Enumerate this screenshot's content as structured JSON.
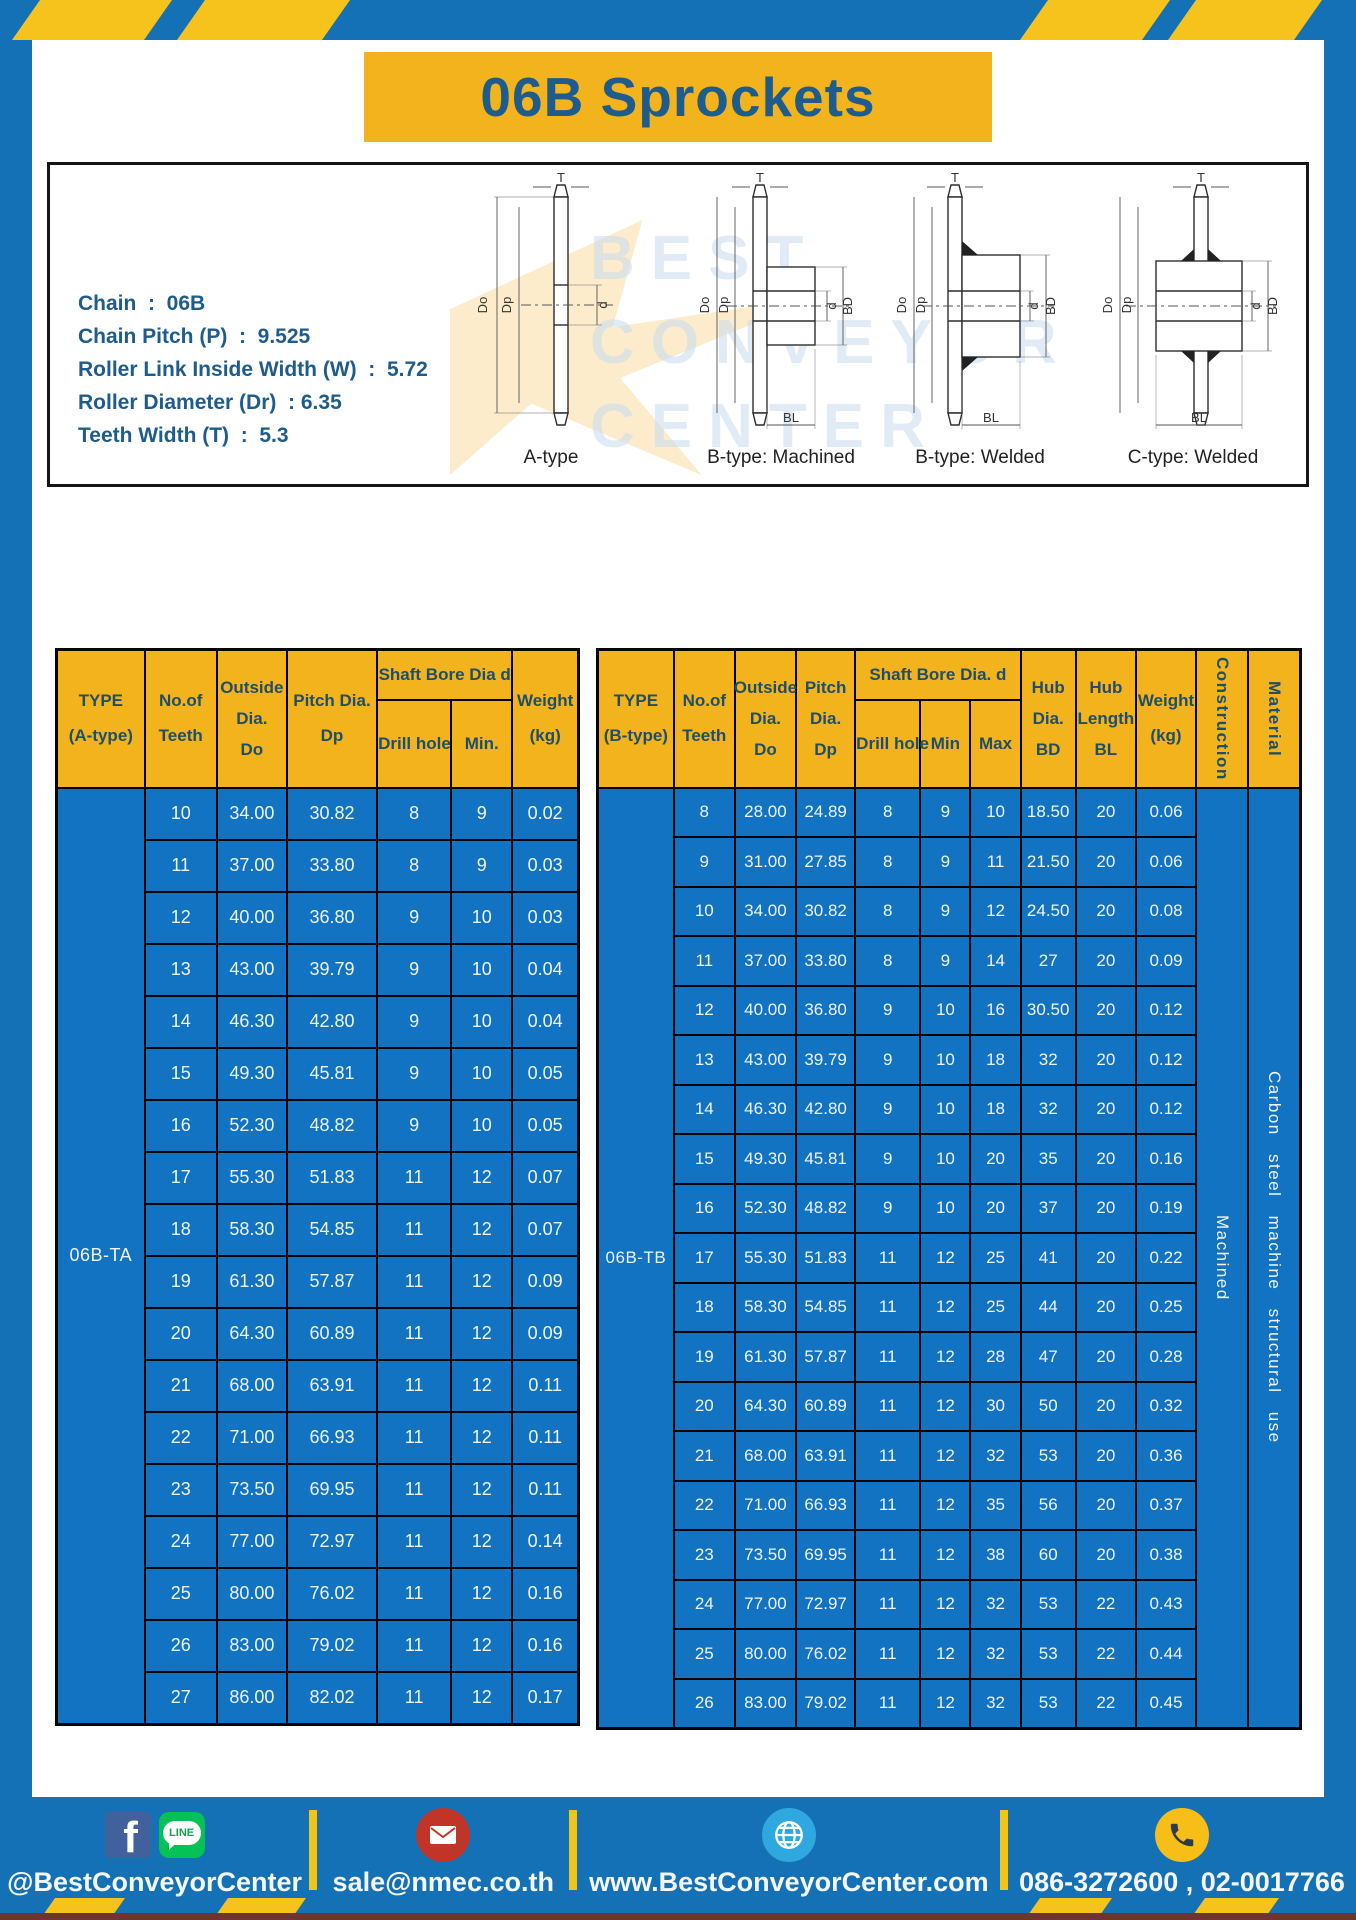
{
  "title": "06B Sprockets",
  "specs": {
    "lines": [
      "Chain  :  06B",
      "Chain Pitch (P)  :  9.525",
      "Roller Link Inside Width (W)  :  5.72",
      "Roller Diameter (Dr)  : 6.35",
      "Teeth Width (T)  :  5.3"
    ]
  },
  "drawings": {
    "captions": [
      "A-type",
      "B-type: Machined",
      "B-type: Welded",
      "C-type: Welded"
    ],
    "dims": {
      "t": "T",
      "do": "Do",
      "dp": "Dp",
      "d": "d",
      "bd": "BD",
      "bl": "BL"
    },
    "watermark": [
      "BEST",
      "CONVEYOR",
      "CENTER"
    ]
  },
  "table_a": {
    "type_label": "06B-TA",
    "headers": {
      "type": [
        "TYPE",
        "(A-type)"
      ],
      "teeth": [
        "No.of",
        "Teeth"
      ],
      "outside": [
        "Outside",
        "Dia.",
        "Do"
      ],
      "pitch": [
        "Pitch Dia.",
        "Dp"
      ],
      "shaft_bore": "Shaft Bore Dia d",
      "drill": "Drill hole",
      "min": "Min.",
      "weight": [
        "Weight",
        "(kg)"
      ]
    },
    "rows": [
      [
        "10",
        "34.00",
        "30.82",
        "8",
        "9",
        "0.02"
      ],
      [
        "11",
        "37.00",
        "33.80",
        "8",
        "9",
        "0.03"
      ],
      [
        "12",
        "40.00",
        "36.80",
        "9",
        "10",
        "0.03"
      ],
      [
        "13",
        "43.00",
        "39.79",
        "9",
        "10",
        "0.04"
      ],
      [
        "14",
        "46.30",
        "42.80",
        "9",
        "10",
        "0.04"
      ],
      [
        "15",
        "49.30",
        "45.81",
        "9",
        "10",
        "0.05"
      ],
      [
        "16",
        "52.30",
        "48.82",
        "9",
        "10",
        "0.05"
      ],
      [
        "17",
        "55.30",
        "51.83",
        "11",
        "12",
        "0.07"
      ],
      [
        "18",
        "58.30",
        "54.85",
        "11",
        "12",
        "0.07"
      ],
      [
        "19",
        "61.30",
        "57.87",
        "11",
        "12",
        "0.09"
      ],
      [
        "20",
        "64.30",
        "60.89",
        "11",
        "12",
        "0.09"
      ],
      [
        "21",
        "68.00",
        "63.91",
        "11",
        "12",
        "0.11"
      ],
      [
        "22",
        "71.00",
        "66.93",
        "11",
        "12",
        "0.11"
      ],
      [
        "23",
        "73.50",
        "69.95",
        "11",
        "12",
        "0.11"
      ],
      [
        "24",
        "77.00",
        "72.97",
        "11",
        "12",
        "0.14"
      ],
      [
        "25",
        "80.00",
        "76.02",
        "11",
        "12",
        "0.16"
      ],
      [
        "26",
        "83.00",
        "79.02",
        "11",
        "12",
        "0.16"
      ],
      [
        "27",
        "86.00",
        "82.02",
        "11",
        "12",
        "0.17"
      ]
    ]
  },
  "table_b": {
    "type_label": "06B-TB",
    "construction": "Machined",
    "material": "Carbon steel machine structural use",
    "headers": {
      "type": [
        "TYPE",
        "(B-type)"
      ],
      "teeth": [
        "No.of",
        "Teeth"
      ],
      "outside": [
        "Outside",
        "Dia.",
        "Do"
      ],
      "pitch": [
        "Pitch",
        "Dia.",
        "Dp"
      ],
      "shaft_bore": "Shaft Bore Dia.  d",
      "drill": "Drill hole",
      "min": "Min",
      "max": "Max",
      "hub_dia": [
        "Hub",
        "Dia.",
        "BD"
      ],
      "hub_len": [
        "Hub",
        "Length",
        "BL"
      ],
      "weight": [
        "Weight",
        "(kg)"
      ],
      "construction": "Construction",
      "material": "Material"
    },
    "rows": [
      [
        "8",
        "28.00",
        "24.89",
        "8",
        "9",
        "10",
        "18.50",
        "20",
        "0.06"
      ],
      [
        "9",
        "31.00",
        "27.85",
        "8",
        "9",
        "11",
        "21.50",
        "20",
        "0.06"
      ],
      [
        "10",
        "34.00",
        "30.82",
        "8",
        "9",
        "12",
        "24.50",
        "20",
        "0.08"
      ],
      [
        "11",
        "37.00",
        "33.80",
        "8",
        "9",
        "14",
        "27",
        "20",
        "0.09"
      ],
      [
        "12",
        "40.00",
        "36.80",
        "9",
        "10",
        "16",
        "30.50",
        "20",
        "0.12"
      ],
      [
        "13",
        "43.00",
        "39.79",
        "9",
        "10",
        "18",
        "32",
        "20",
        "0.12"
      ],
      [
        "14",
        "46.30",
        "42.80",
        "9",
        "10",
        "18",
        "32",
        "20",
        "0.12"
      ],
      [
        "15",
        "49.30",
        "45.81",
        "9",
        "10",
        "20",
        "35",
        "20",
        "0.16"
      ],
      [
        "16",
        "52.30",
        "48.82",
        "9",
        "10",
        "20",
        "37",
        "20",
        "0.19"
      ],
      [
        "17",
        "55.30",
        "51.83",
        "11",
        "12",
        "25",
        "41",
        "20",
        "0.22"
      ],
      [
        "18",
        "58.30",
        "54.85",
        "11",
        "12",
        "25",
        "44",
        "20",
        "0.25"
      ],
      [
        "19",
        "61.30",
        "57.87",
        "11",
        "12",
        "28",
        "47",
        "20",
        "0.28"
      ],
      [
        "20",
        "64.30",
        "60.89",
        "11",
        "12",
        "30",
        "50",
        "20",
        "0.32"
      ],
      [
        "21",
        "68.00",
        "63.91",
        "11",
        "12",
        "32",
        "53",
        "20",
        "0.36"
      ],
      [
        "22",
        "71.00",
        "66.93",
        "11",
        "12",
        "35",
        "56",
        "20",
        "0.37"
      ],
      [
        "23",
        "73.50",
        "69.95",
        "11",
        "12",
        "38",
        "60",
        "20",
        "0.38"
      ],
      [
        "24",
        "77.00",
        "72.97",
        "11",
        "12",
        "32",
        "53",
        "22",
        "0.43"
      ],
      [
        "25",
        "80.00",
        "76.02",
        "11",
        "12",
        "32",
        "53",
        "22",
        "0.44"
      ],
      [
        "26",
        "83.00",
        "79.02",
        "11",
        "12",
        "32",
        "53",
        "22",
        "0.45"
      ]
    ]
  },
  "footer": {
    "facebook_glyph": "f",
    "line_text": "LINE",
    "items": [
      {
        "label": "@BestConveyorCenter"
      },
      {
        "label": "sale@nmec.co.th"
      },
      {
        "label": "www.BestConveyorCenter.com"
      },
      {
        "label": "086-3272600 , 02-0017766"
      }
    ]
  },
  "colors": {
    "frame_blue": "#1571B5",
    "cell_blue": "#1273C2",
    "accent_yellow": "#F2B31D",
    "title_navy": "#1D5C8C"
  }
}
